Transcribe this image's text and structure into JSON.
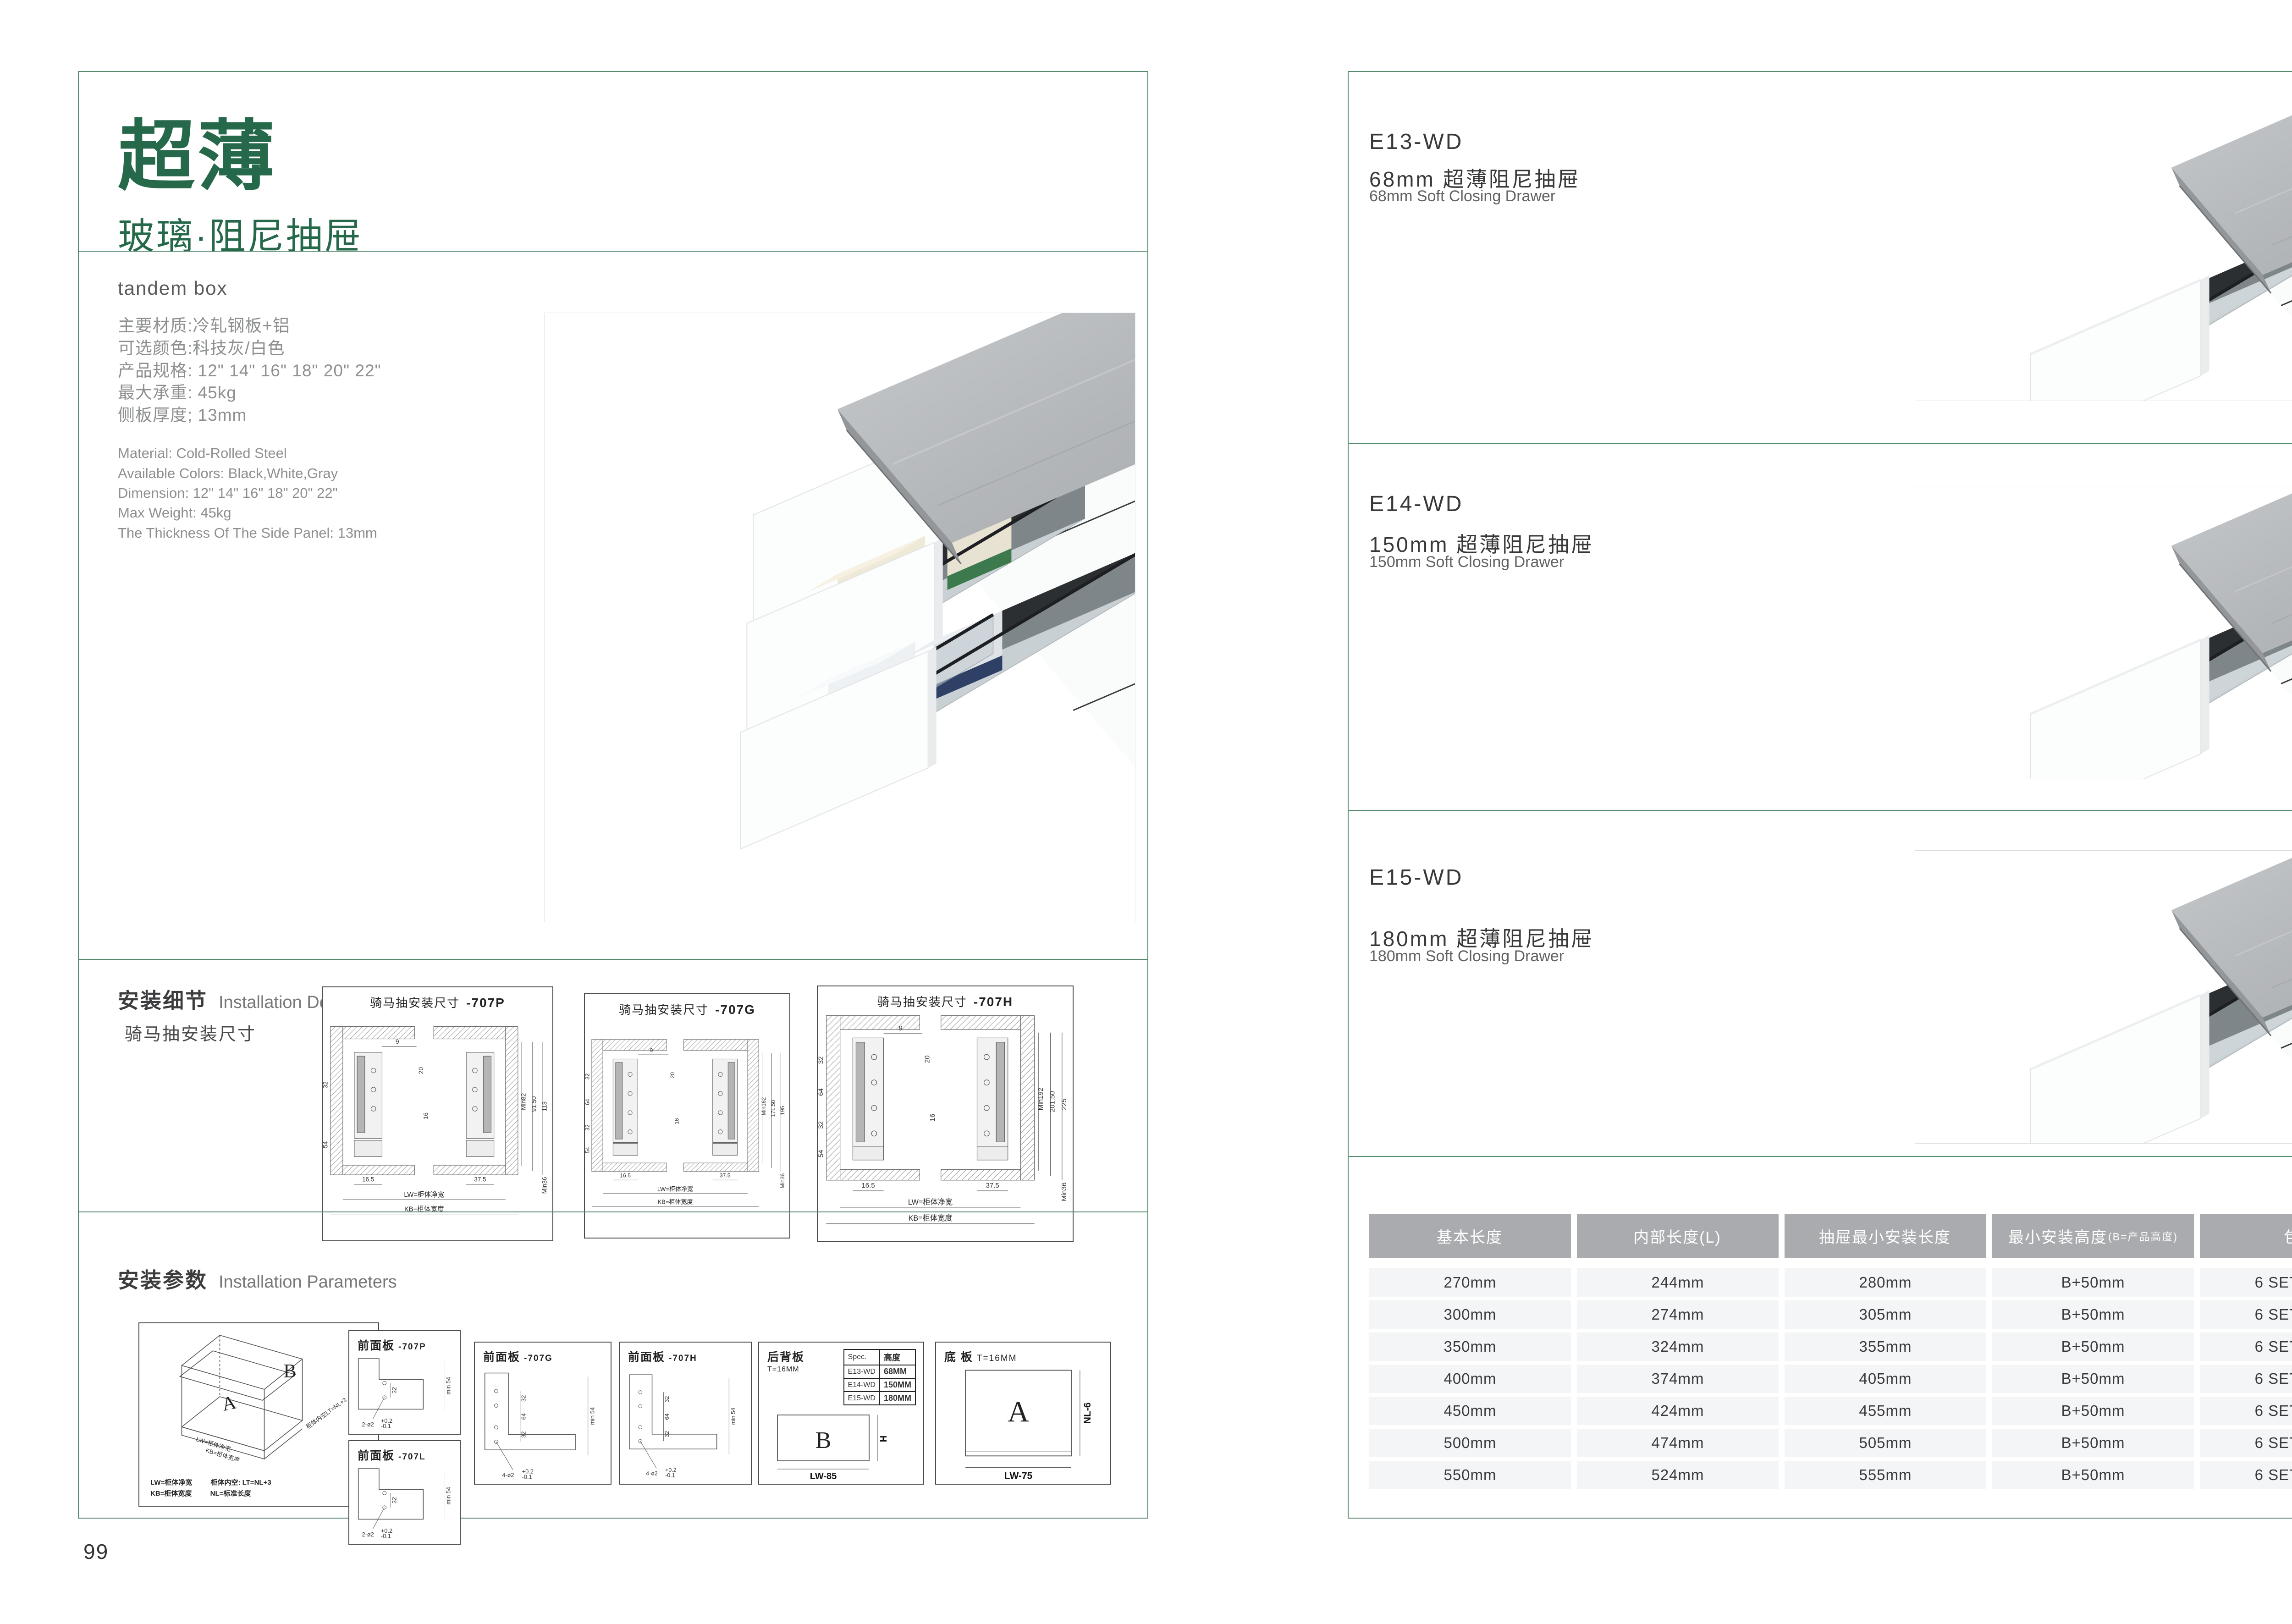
{
  "colors": {
    "accent_green": "#26694a",
    "border_green": "#578a6e",
    "table_header_bg": "#a9abae",
    "table_row_bg": "#f4f5f6",
    "text_dark": "#3a3a3c",
    "text_gray": "#8d8f90"
  },
  "left_page": {
    "page_number": "99",
    "header": {
      "title": "超薄",
      "subtitle": "玻璃·阻尼抽屉",
      "caption": "tandem box"
    },
    "specs": {
      "cn": [
        "主要材质:冷轧钢板+铝",
        "可选颜色:科技灰/白色",
        "产品规格: 12\" 14\" 16\" 18\" 20\" 22\"",
        "最大承重: 45kg",
        "侧板厚度; 13mm"
      ],
      "en": [
        "Material: Cold-Rolled Steel",
        "Available Colors: Black,White,Gray",
        "Dimension: 12\" 14\" 16\" 18\" 20\" 22\"",
        "Max Weight: 45kg",
        "The Thickness Of The Side Panel: 13mm"
      ]
    },
    "install_details": {
      "title_cn": "安装细节",
      "title_en": "Installation Details",
      "subtitle": "骑马抽安装尺寸",
      "diagrams": [
        {
          "caption": "骑马抽安装尺寸",
          "model": "-707P",
          "right_dims": [
            "Min82",
            "91.50",
            "113"
          ],
          "side_dims": [
            "32",
            "54"
          ],
          "top_dim": "9",
          "top_dim2": "20",
          "center_dim": "16",
          "bottom_dims": [
            "16.5",
            "37.5"
          ],
          "width_labels": [
            "LW=柜体净宽",
            "KB=柜体宽度"
          ],
          "min_bottom": "Min36"
        },
        {
          "caption": "骑马抽安装尺寸",
          "model": "-707G",
          "right_dims": [
            "Min162",
            "171.50",
            "195"
          ],
          "side_dims": [
            "32",
            "64",
            "32",
            "54"
          ],
          "top_dim": "9",
          "top_dim2": "20",
          "center_dim": "16",
          "bottom_dims": [
            "16.5",
            "37.5"
          ],
          "width_labels": [
            "LW=柜体净宽",
            "KB=柜体宽度"
          ],
          "min_bottom": "Min36"
        },
        {
          "caption": "骑马抽安装尺寸",
          "model": "-707H",
          "right_dims": [
            "Min192",
            "201.50",
            "225"
          ],
          "side_dims": [
            "32",
            "64",
            "32",
            "54"
          ],
          "top_dim": "9",
          "top_dim2": "20",
          "center_dim": "16",
          "bottom_dims": [
            "16.5",
            "37.5"
          ],
          "width_labels": [
            "LW=柜体净宽",
            "KB=柜体宽度"
          ],
          "min_bottom": "Min36"
        }
      ]
    },
    "install_params": {
      "title_cn": "安装参数",
      "title_en": "Installation Parameters",
      "iso": {
        "letter_back": "B",
        "letter_base": "A",
        "dim_lw": "LW=柜体净宽",
        "dim_kb": "KB=柜体宽度",
        "dim_lt": "柜体内空LT=NL+3",
        "legend": [
          [
            "LW=柜体净宽",
            "柜体内空: LT=NL+3"
          ],
          [
            "KB=柜体宽度",
            "NL=标准长度"
          ]
        ]
      },
      "front_panels": [
        {
          "title": "前面板",
          "model": "-707P",
          "hole_label": "2-ø2",
          "tol_top": "+0.2",
          "tol_bottom": "-0.1",
          "dim_pitch": "32",
          "dim_min": "min 54"
        },
        {
          "title": "前面板",
          "model": "-707L",
          "hole_label": "2-ø2",
          "tol_top": "+0.2",
          "tol_bottom": "-0.1",
          "dim_pitch": "32",
          "dim_min": "min 54"
        },
        {
          "title": "前面板",
          "model": "-707G",
          "hole_label": "4-ø2",
          "tol_top": "+0.2",
          "tol_bottom": "-0.1",
          "dims": [
            "32",
            "64",
            "32"
          ],
          "dim_min": "min 54"
        },
        {
          "title": "前面板",
          "model": "-707H",
          "hole_label": "4-ø2",
          "tol_top": "+0.2",
          "tol_bottom": "-0.1",
          "dims": [
            "32",
            "64",
            "32"
          ],
          "dim_min": "min 54"
        }
      ],
      "back_panel": {
        "title": "后背板",
        "thickness": "T=16MM",
        "letter": "B",
        "dim_height": "H",
        "dim_width": "LW-85",
        "spec_table": {
          "headers": [
            "Spec.",
            "高度"
          ],
          "rows": [
            [
              "E13-WD",
              "68MM"
            ],
            [
              "E14-WD",
              "150MM"
            ],
            [
              "E15-WD",
              "180MM"
            ]
          ]
        }
      },
      "bottom_panel": {
        "title": "底 板",
        "thickness": "T=16MM",
        "letter": "A",
        "dim_height": "NL-6",
        "dim_width": "LW-75"
      }
    }
  },
  "right_page": {
    "page_number": "100",
    "products": [
      {
        "model": "E13-WD",
        "name_cn": "68mm 超薄阻尼抽屉",
        "name_en": "68mm Soft Closing Drawer"
      },
      {
        "model": "E14-WD",
        "name_cn": "150mm 超薄阻尼抽屉",
        "name_en": "150mm Soft Closing Drawer"
      },
      {
        "model": "E15-WD",
        "name_cn": "180mm 超薄阻尼抽屉",
        "name_en": "180mm Soft Closing Drawer"
      }
    ],
    "table": {
      "headers": [
        {
          "label": "基本长度",
          "sub": ""
        },
        {
          "label": "内部长度(L)",
          "sub": ""
        },
        {
          "label": "抽屉最小安装长度",
          "sub": ""
        },
        {
          "label": "最小安装高度",
          "sub": "(B=产品高度)"
        },
        {
          "label": "包装",
          "sub": ""
        }
      ],
      "rows": [
        [
          "270mm",
          "244mm",
          "280mm",
          "B+50mm",
          "6 SETC/TNB"
        ],
        [
          "300mm",
          "274mm",
          "305mm",
          "B+50mm",
          "6 SETC/TNB"
        ],
        [
          "350mm",
          "324mm",
          "355mm",
          "B+50mm",
          "6 SETC/TNB"
        ],
        [
          "400mm",
          "374mm",
          "405mm",
          "B+50mm",
          "6 SETC/TNB"
        ],
        [
          "450mm",
          "424mm",
          "455mm",
          "B+50mm",
          "6 SETC/TNB"
        ],
        [
          "500mm",
          "474mm",
          "505mm",
          "B+50mm",
          "6 SETC/TNB"
        ],
        [
          "550mm",
          "524mm",
          "555mm",
          "B+50mm",
          "6 SETC/TNB"
        ]
      ]
    }
  }
}
